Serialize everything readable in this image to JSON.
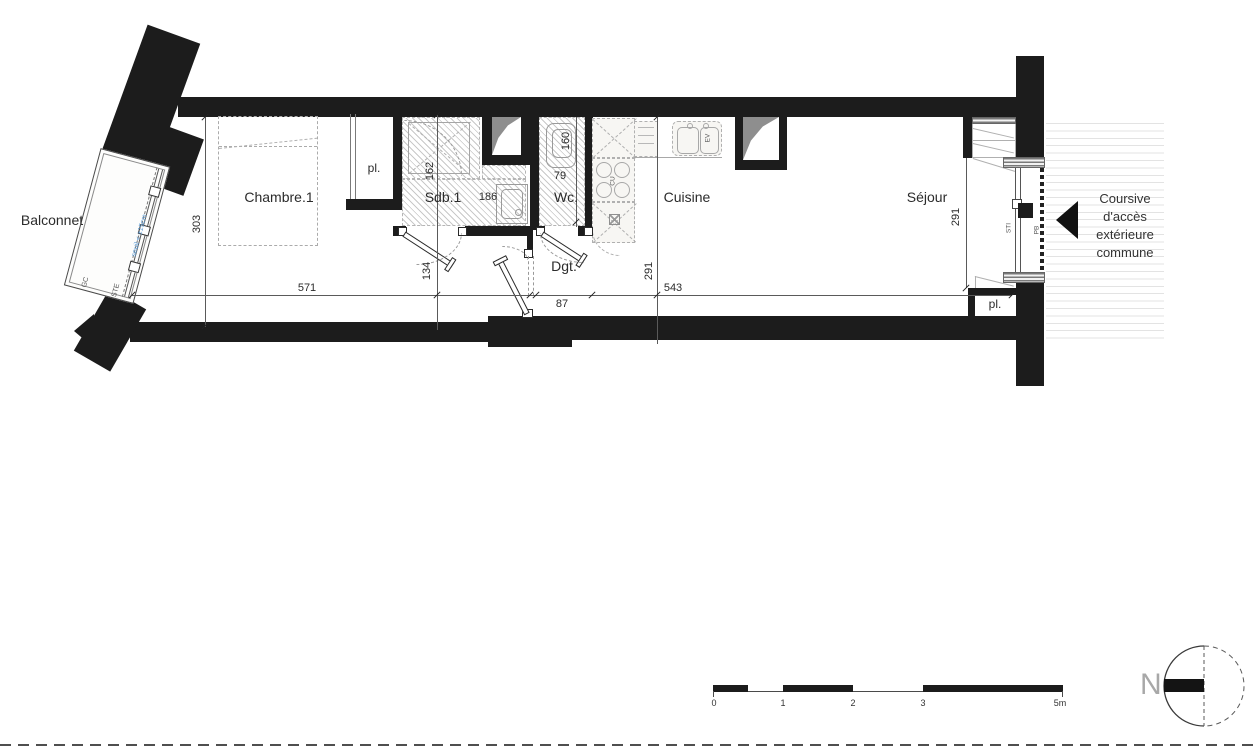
{
  "labels": {
    "balcony": "Balconnet",
    "gc": "GC",
    "ste": "STE",
    "seuil": "seuil < ±15cm",
    "chambre": "Chambre.1",
    "pl_left": "pl.",
    "sdb": "Sdb.1",
    "wc": "Wc.",
    "dgt": "Dgt.",
    "cuisine": "Cuisine",
    "sejour": "Séjour",
    "pl_right": "pl.",
    "cu": "CU",
    "ev": "EV",
    "sti": "STI",
    "pb": "PB",
    "north": "N"
  },
  "dimensions": {
    "d303": "303",
    "d571": "571",
    "d162": "162",
    "d186": "186",
    "d134": "134",
    "d160": "160",
    "d79": "79",
    "d87": "87",
    "d291_cuisine": "291",
    "d543": "543",
    "d291_sejour": "291"
  },
  "coursive_lines": [
    "Coursive",
    "d'accès",
    "extérieure",
    "commune"
  ],
  "scale_bar": {
    "ticks": [
      "0",
      "1",
      "2",
      "3",
      "5m"
    ]
  },
  "colors": {
    "wall": "#1c1c1c",
    "dimension": "#3a3a3a",
    "furniture": "#9a9a9a",
    "hatch": "#c9c9c9",
    "seuil_blue": "#5b9bd5",
    "north_gray": "#a8a8a8",
    "coursive_stripe": "#e3e3e3"
  }
}
